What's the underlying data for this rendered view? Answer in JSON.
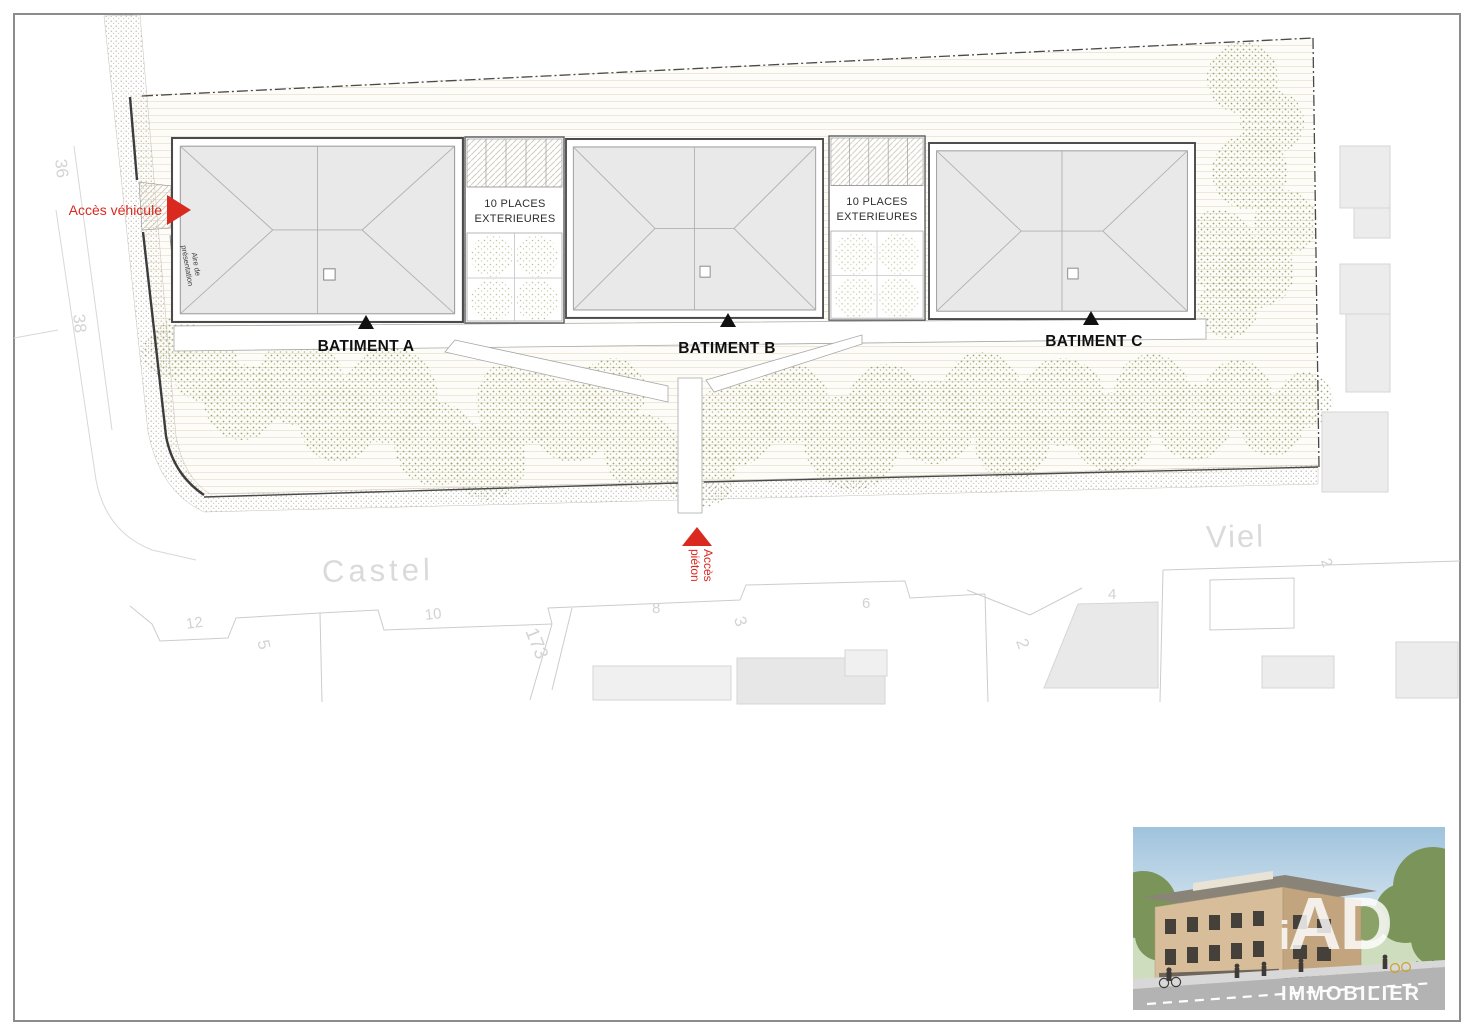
{
  "plan": {
    "access_vehicule_label": "Accès véhicule",
    "access_pieton": {
      "line1": "Accès",
      "line2": "piéton"
    },
    "aire_presentation": {
      "line1": "Aire de",
      "line2": "présentation"
    },
    "buildings": [
      {
        "label": "BATIMENT A"
      },
      {
        "label": "BATIMENT B"
      },
      {
        "label": "BATIMENT C"
      }
    ],
    "parkings": [
      {
        "line1": "10 PLACES",
        "line2": "EXTERIEURES"
      },
      {
        "line1": "10 PLACES",
        "line2": "EXTERIEURES"
      }
    ],
    "streets": {
      "castel": "Castel",
      "viel": "Viel"
    },
    "parcels": {
      "p36": "36",
      "p38": "38",
      "p12": "12",
      "p5": "5",
      "p10": "10",
      "p173": "173",
      "p8": "8",
      "p3": "3",
      "p6": "6",
      "p2a": "2",
      "p4": "4",
      "p2b": "2"
    }
  },
  "logo": {
    "i": "i",
    "ad": "AD",
    "wordmark": "IMMOBILIER"
  },
  "colors": {
    "access_red": "#da2a20",
    "roof_fill": "#e9e9e9",
    "tree_green": "#8d9660",
    "street_text": "#dadada",
    "site_background": "#fdfcf8"
  }
}
